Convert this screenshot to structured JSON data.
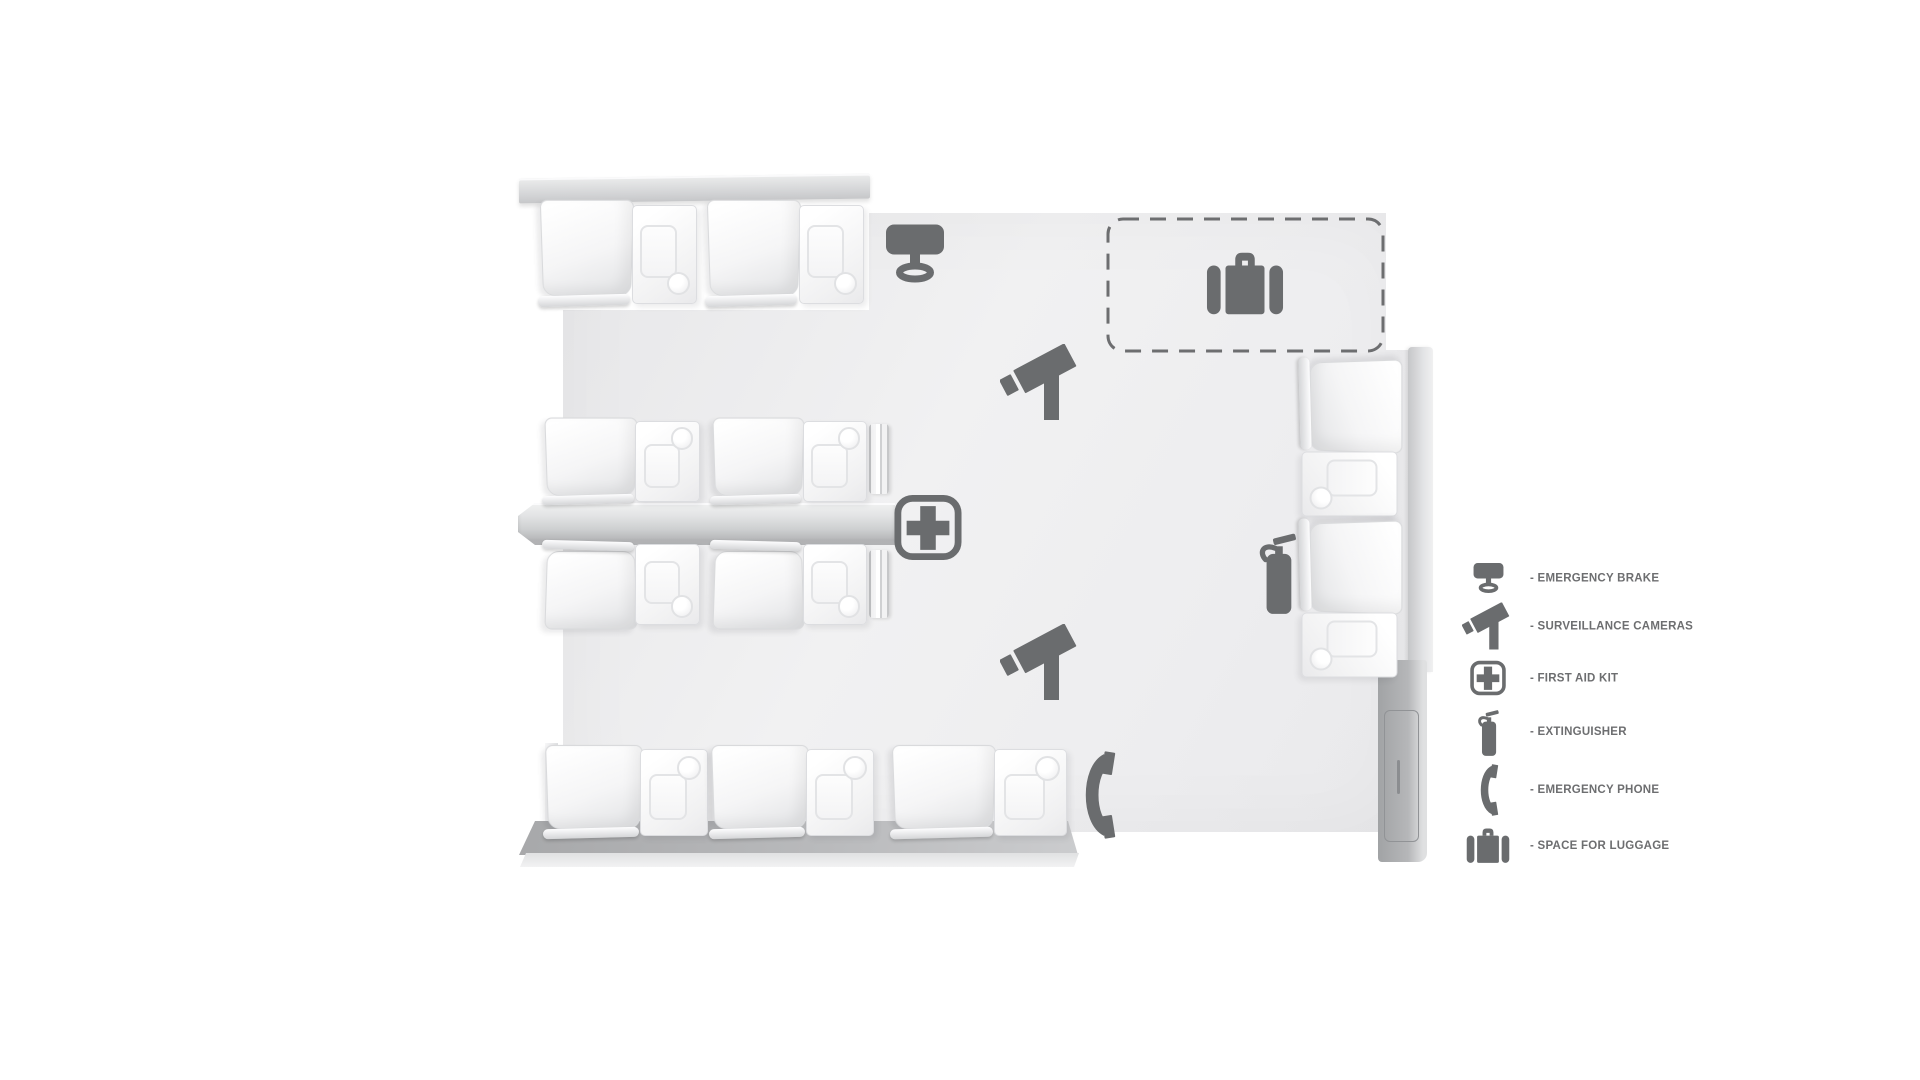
{
  "legend": {
    "items": [
      {
        "icon": "emergency-brake-icon",
        "label": "- EMERGENCY BRAKE"
      },
      {
        "icon": "surveillance-camera-icon",
        "label": "- SURVEILLANCE CAMERAS"
      },
      {
        "icon": "first-aid-kit-icon",
        "label": "- FIRST AID KIT"
      },
      {
        "icon": "extinguisher-icon",
        "label": "- EXTINGUISHER"
      },
      {
        "icon": "emergency-phone-icon",
        "label": "- EMERGENCY PHONE"
      },
      {
        "icon": "luggage-space-icon",
        "label": "- SPACE FOR LUGGAGE"
      }
    ]
  },
  "plan": {
    "type": "train-car-interior-top-view-floor-plan",
    "seat_groups": [
      {
        "id": "top-left",
        "seat_pairs": 2
      },
      {
        "id": "middle-upper",
        "seat_pairs": 2
      },
      {
        "id": "middle-lower",
        "seat_pairs": 2
      },
      {
        "id": "bottom",
        "seat_pairs": 3
      },
      {
        "id": "right-wall",
        "seat_pairs": 2
      }
    ],
    "markers": [
      "emergency-brake-icon",
      "luggage-space-icon",
      "surveillance-camera-icon",
      "surveillance-camera-icon",
      "first-aid-kit-icon",
      "extinguisher-icon",
      "emergency-phone-icon"
    ]
  },
  "colors": {
    "background": "#ffffff",
    "floor": "#efeff0",
    "icon": "#6a6c6e",
    "legend_text": "#6d6e70",
    "dashed_outline": "#6d6e70"
  }
}
